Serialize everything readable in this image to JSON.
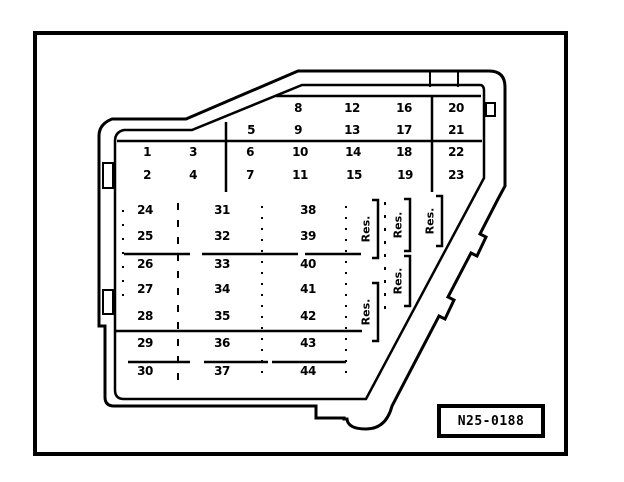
{
  "fusebox": {
    "upper_rows": [
      [
        "8",
        "12",
        "16",
        "20"
      ],
      [
        "5",
        "9",
        "13",
        "17",
        "21"
      ],
      [
        "1",
        "3",
        "6",
        "10",
        "14",
        "18",
        "22"
      ],
      [
        "2",
        "4",
        "7",
        "11",
        "15",
        "19",
        "23"
      ]
    ],
    "lower_cols": [
      [
        "24",
        "25",
        "26",
        "27",
        "28",
        "29",
        "30"
      ],
      [
        "31",
        "32",
        "33",
        "34",
        "35",
        "36",
        "37"
      ],
      [
        "38",
        "39",
        "40",
        "41",
        "42",
        "43",
        "44"
      ]
    ],
    "reserve_labels": [
      "Res.",
      "Res.",
      "Res.",
      "Res.",
      "Res."
    ],
    "figure_label": "N25-0188",
    "line_color": "#000000",
    "background_color": "#ffffff"
  }
}
